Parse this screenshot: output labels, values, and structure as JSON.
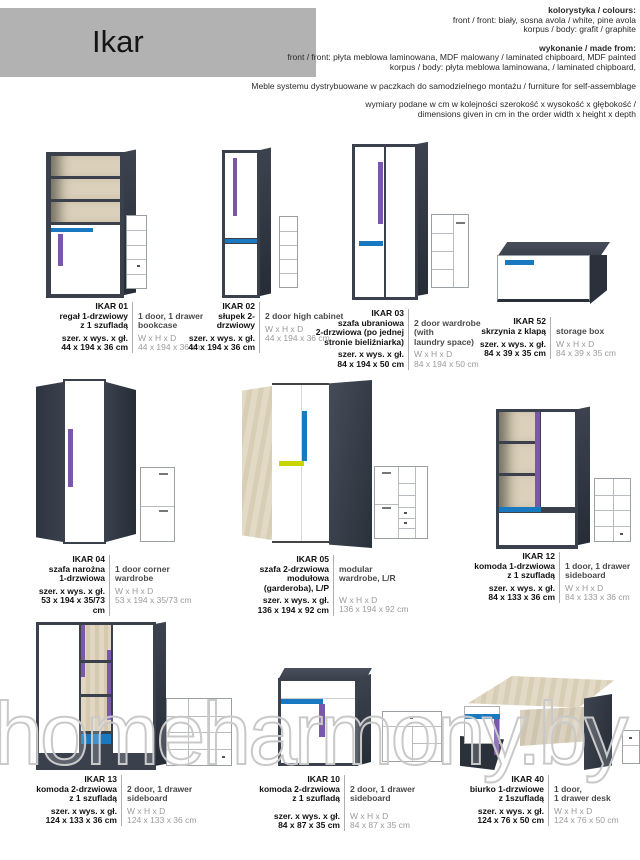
{
  "page": {
    "title": "Ikar",
    "watermark": "homeharmony.by"
  },
  "header": {
    "colors_heading": "kolorystyka / colours:",
    "colors_line1": "front / front: biały, sosna avola / white, pine avola",
    "colors_line2": "korpus / body: grafit / graphite",
    "made_heading": "wykonanie / made from:",
    "made_line1": "front / front: płyta meblowa laminowana, MDF malowany / laminated chipboard, MDF painted",
    "made_line2": "korpus / body: płyta meblowa laminowana, / laminated chipboard,",
    "distribution": "Meble systemu dystrybuowane w paczkach do samodzielnego montażu / furniture for self-assemblage",
    "dims_note1": "wymiary podane w cm w kolejności szerokość x wysokość x głębokość /",
    "dims_note2": "dimensions given in cm in the order width x height x depth"
  },
  "labels": {
    "dims_pl": "szer. x wys. x gł.",
    "dims_en": "W x H x D"
  },
  "products": [
    {
      "code": "IKAR 01",
      "name_pl": "regał 1-drzwiowy\nz 1 szufladą",
      "name_en": "1 door, 1 drawer\nbookcase",
      "dims_pl": "44 x 194 x 36 cm",
      "dims_en": "44 x 194 x 36 cm"
    },
    {
      "code": "IKAR 02",
      "name_pl": "słupek 2-drzwiowy",
      "name_en": "2 door high cabinet",
      "dims_pl": "44 x 194 x 36 cm",
      "dims_en": "44 x 194 x 36 cm"
    },
    {
      "code": "IKAR 03",
      "name_pl": "szafa ubraniowa\n2-drzwiowa (po jednej\nstronie bieliźniarka)",
      "name_en": "2 door wardrobe (with\nlaundry space)",
      "dims_pl": "84 x 194 x 50 cm",
      "dims_en": "84 x 194 x 50 cm"
    },
    {
      "code": "IKAR 52",
      "name_pl": "skrzynia z klapą",
      "name_en": "storage box",
      "dims_pl": "84 x 39 x 35 cm",
      "dims_en": "84 x 39 x 35 cm"
    },
    {
      "code": "IKAR 04",
      "name_pl": "szafa narożna\n1-drzwiowa",
      "name_en": "1 door corner\nwardrobe",
      "dims_pl": "53 x 194 x 35/73 cm",
      "dims_en": "53 x 194 x 35/73 cm"
    },
    {
      "code": "IKAR 05",
      "name_pl": "szafa 2-drzwiowa\nmodułowa\n(garderoba), L/P",
      "name_en": "modular\nwardrobe, L/R",
      "dims_pl": "136 x 194 x 92 cm",
      "dims_en": "136 x 194 x 92 cm"
    },
    {
      "code": "IKAR 12",
      "name_pl": "komoda 1-drzwiowa\nz 1 szufladą",
      "name_en": "1 door, 1 drawer\nsideboard",
      "dims_pl": "84 x 133 x 36 cm",
      "dims_en": "84 x 133 x 36 cm"
    },
    {
      "code": "IKAR 13",
      "name_pl": "komoda 2-drzwiowa\nz 1 szufladą",
      "name_en": "2 door, 1 drawer\nsideboard",
      "dims_pl": "124 x 133 x 36 cm",
      "dims_en": "124 x 133 x 36 cm"
    },
    {
      "code": "IKAR 10",
      "name_pl": "komoda 2-drzwiowa\nz 1 szufladą",
      "name_en": "2 door, 1 drawer\nsideboard",
      "dims_pl": "84 x 87 x 35 cm",
      "dims_en": "84 x 87 x 35 cm"
    },
    {
      "code": "IKAR 40",
      "name_pl": "biurko 1-drzwiowe\nz 1szufladą",
      "name_en": "1 door,\n1 drawer desk",
      "dims_pl": "124 x 76 x 50 cm",
      "dims_en": "124 x 76 x 50 cm"
    }
  ],
  "colors": {
    "graphite": "#3a414d",
    "blue": "#1879c0",
    "purple": "#7a57a8",
    "yellow": "#c8d400",
    "pine_avola": "#dbd0ba",
    "header_gray": "#b2b2b2"
  }
}
